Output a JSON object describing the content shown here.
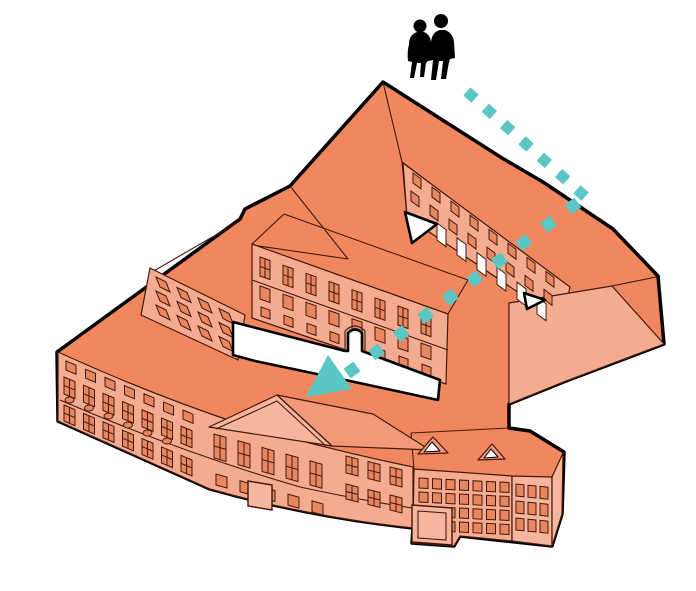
{
  "title": "Axonometric illustration of a historic courtyard building complex with a dashed entry route",
  "legend": {
    "people": "two visitors walking",
    "route": "entry route into the courtyard",
    "building": "courtyard building complex",
    "courtyard": "inner courtyard"
  },
  "colors": {
    "background": "#FFFFFF",
    "roof": "#F0875F",
    "roof_light": "#F2997A",
    "facade": "#F4AB8F",
    "facade_light": "#F6B69E",
    "window": "#E8875F",
    "outline": "#000000",
    "line": "#42190C",
    "path_teal": "#5BC7C5",
    "figures": "#000000",
    "courtyard": "#FFFFFF"
  },
  "arrow": {
    "segments": [
      {
        "x1": 471,
        "y1": 95,
        "x2": 581,
        "y2": 193,
        "n": 7,
        "size": 11
      },
      {
        "x1": 573,
        "y1": 206,
        "x2": 352,
        "y2": 370,
        "n": 10,
        "size": 12
      }
    ],
    "head_points": "306,397 328,355 352,389"
  }
}
